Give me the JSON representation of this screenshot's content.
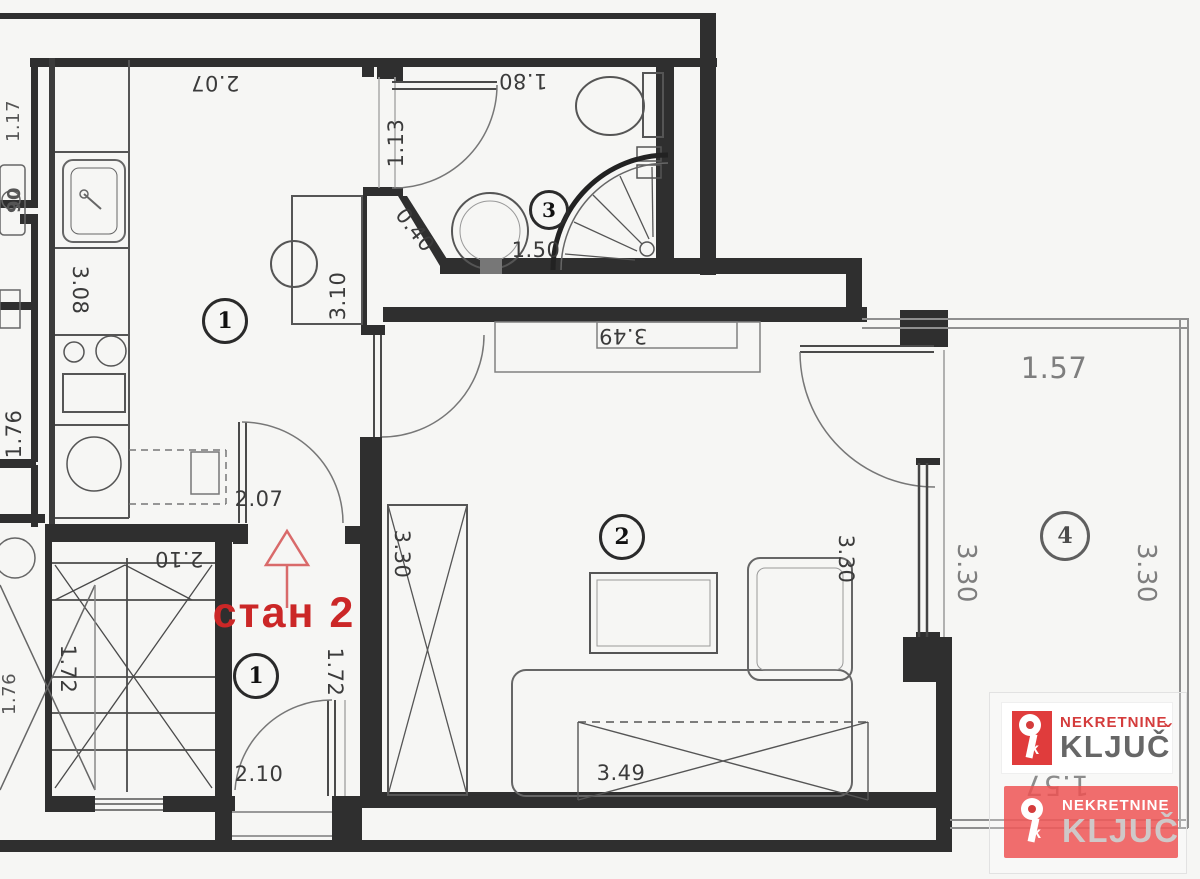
{
  "plan": {
    "apartment_label": "стан 2",
    "rooms": [
      {
        "id": "kitchen",
        "number": "1"
      },
      {
        "id": "living-room",
        "number": "2"
      },
      {
        "id": "bathroom",
        "number": "3"
      },
      {
        "id": "terrace",
        "number": "4"
      },
      {
        "id": "hall",
        "number": "1"
      }
    ],
    "dimensions": {
      "kitchen_width_top": "2.07",
      "kitchen_counter": "3.08",
      "kitchen_shaft": "3.10",
      "kitchen_width_bottom": "2.07",
      "bath_width": "1.80",
      "bath_door": "1.13",
      "bath_chamfer": "0.40",
      "bath_length": "1.50",
      "stairs_width": "2.10",
      "stairs_depth": "1.72",
      "hall_depth": "1.72",
      "hall_width": "2.10",
      "living_width_top": "3.49",
      "living_height_left": "3.30",
      "living_height_right": "3.30",
      "living_sofa": "3.49",
      "terrace_width_top": "1.57",
      "terrace_height_left": "3.30",
      "terrace_height_right": "3.30",
      "terrace_width_bottom": "1.57",
      "neighbor_a": "1.17",
      "neighbor_b": "90",
      "neighbor_c": "1.76",
      "neighbor_d": "1.76"
    }
  },
  "branding": {
    "brand_top": "NEKRETNINE",
    "brand_main": "KLJUČ",
    "caron": "ˇ",
    "icon_letter": "k",
    "colors": {
      "red": "#e03c3c",
      "gray": "#676767"
    }
  },
  "colors": {
    "wall": "#2f2f2f",
    "furniture_line": "#666666",
    "dimension_text": "#3b3b3b",
    "light_text": "#7e7e7e",
    "accent_red": "#cb2727"
  }
}
